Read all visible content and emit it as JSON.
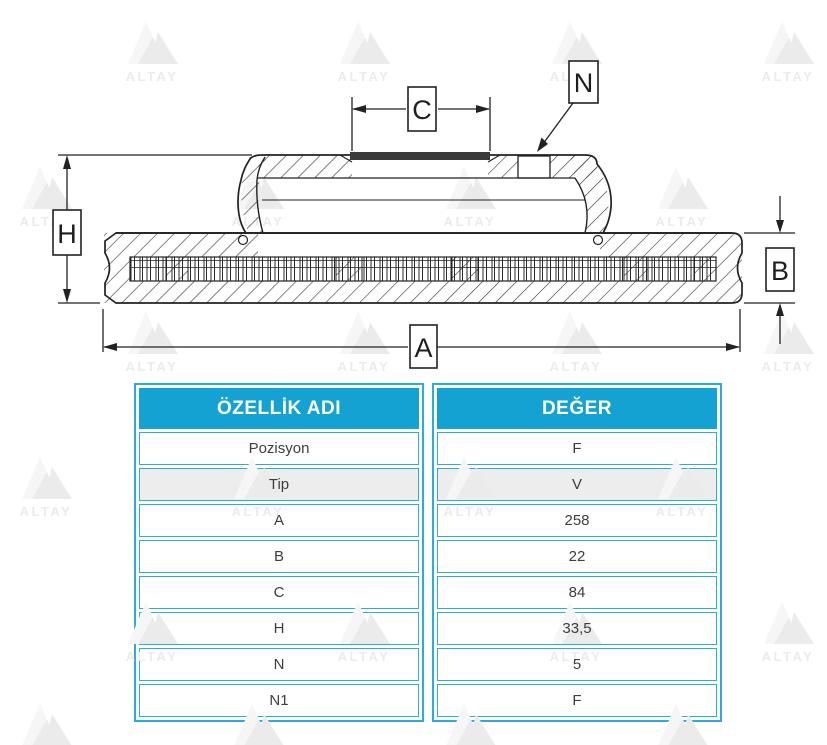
{
  "watermark": {
    "text": "ALTAY"
  },
  "diagram": {
    "dim_labels": {
      "H": "H",
      "C": "C",
      "N": "N",
      "A": "A",
      "B": "B"
    }
  },
  "table": {
    "columns": [
      "ÖZELLİK ADI",
      "DEĞER"
    ],
    "rows": [
      {
        "name": "Pozisyon",
        "value": "F",
        "shaded": false
      },
      {
        "name": "Tip",
        "value": "V",
        "shaded": true
      },
      {
        "name": "A",
        "value": "258",
        "shaded": false
      },
      {
        "name": "B",
        "value": "22",
        "shaded": false
      },
      {
        "name": "C",
        "value": "84",
        "shaded": false
      },
      {
        "name": "H",
        "value": "33,5",
        "shaded": false
      },
      {
        "name": "N",
        "value": "5",
        "shaded": false
      },
      {
        "name": "N1",
        "value": "F",
        "shaded": false
      }
    ]
  },
  "colors": {
    "accent": "#14a2d2",
    "border": "#2badd8",
    "row_shaded": "#ededed",
    "cell_text": "#3d3d3d",
    "watermark": "#ebebeb",
    "line": "#222222",
    "dark_band": "#3a3a3a"
  }
}
